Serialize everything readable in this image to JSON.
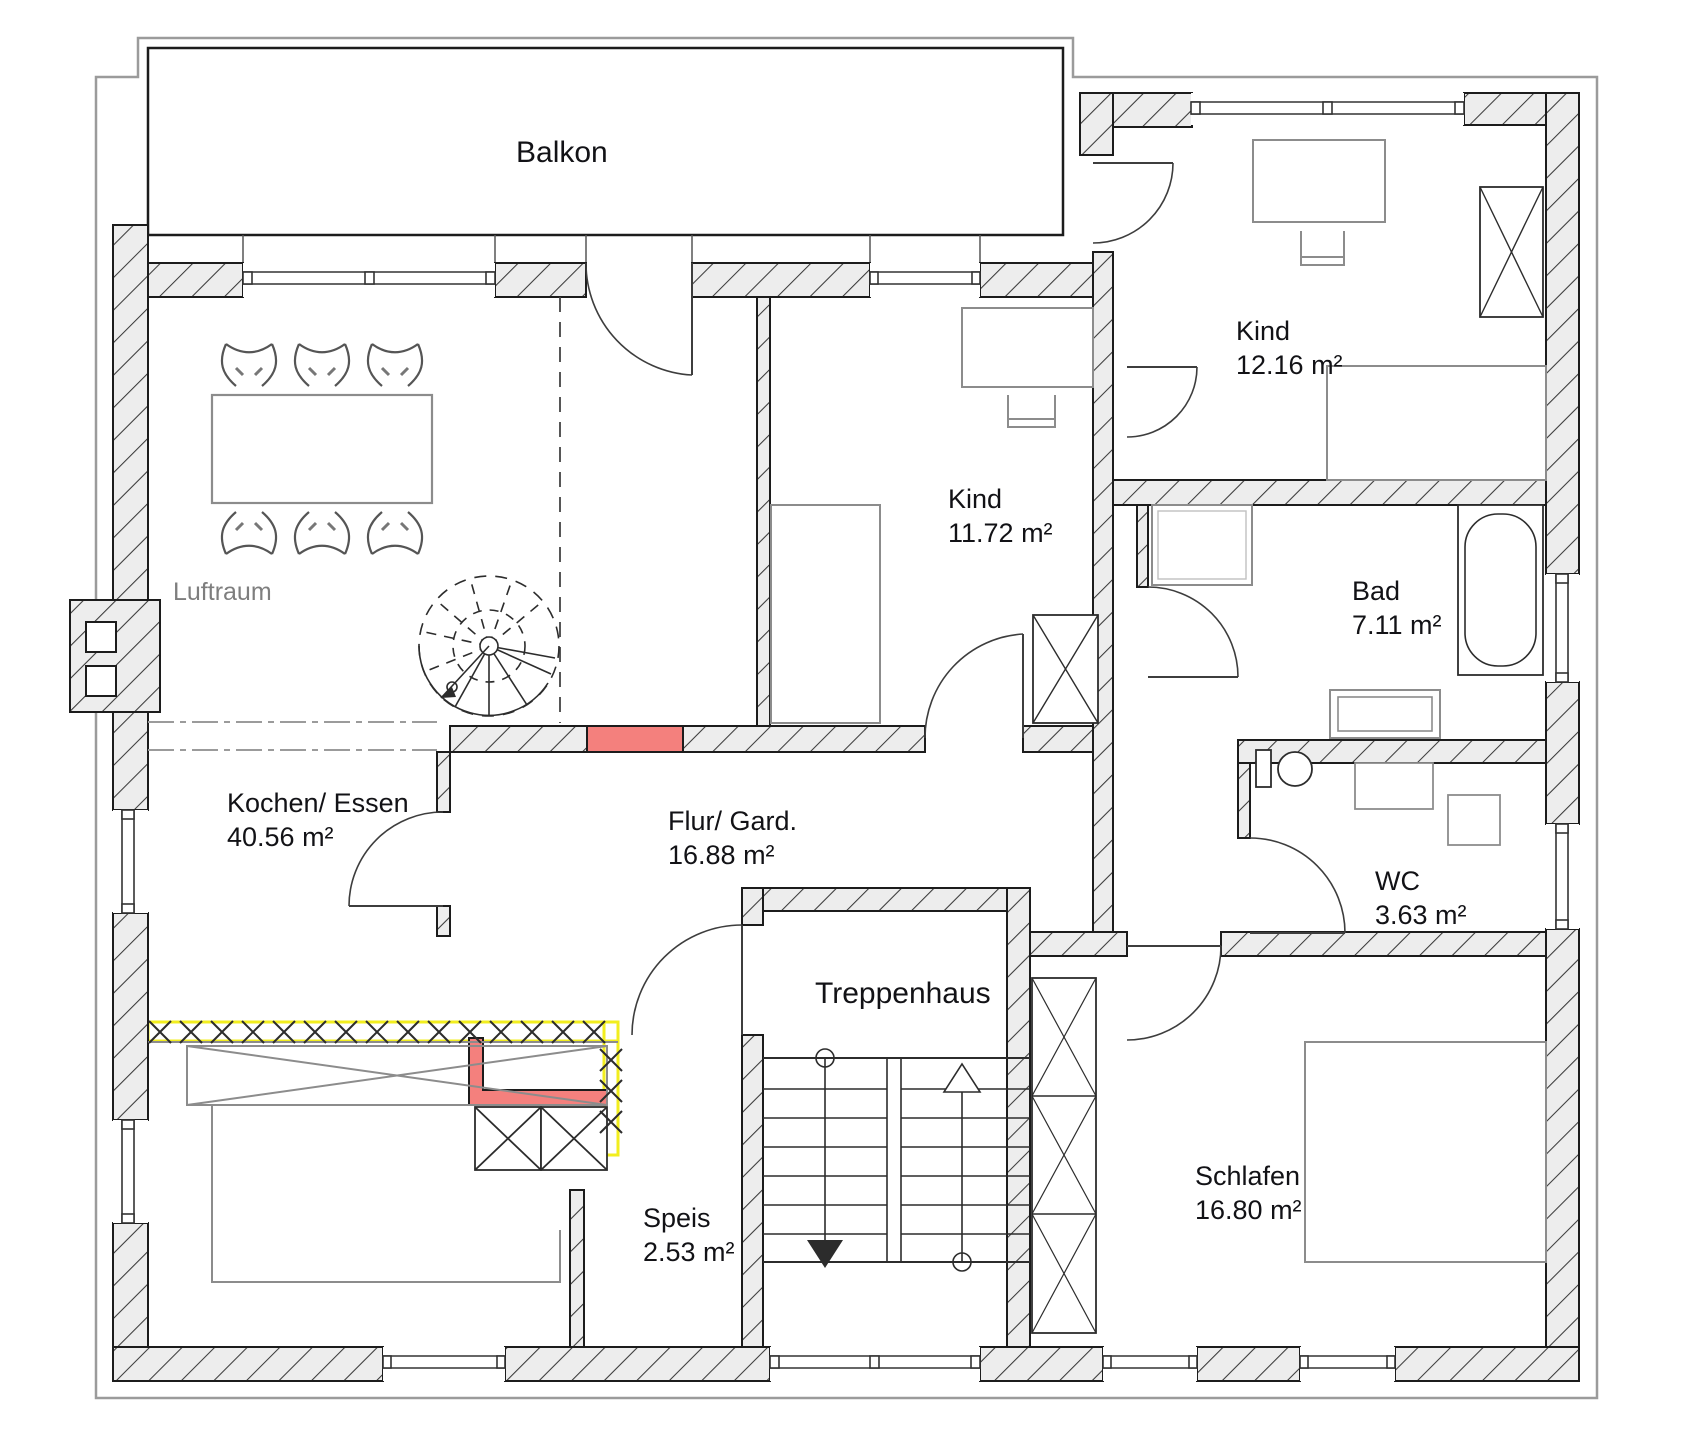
{
  "app": {
    "canvas_label": "Grundriss Obergeschoss Zeichnung"
  },
  "colors": {
    "wall_hatch_bg": "#ededed",
    "wall_line": "#1c1c1c",
    "highlight_red": "#f4807d",
    "highlight_yellow": "#f2ee1e",
    "lot_line": "#9b9b9b",
    "furniture_gray": "#8c8c8c",
    "text": "#121216",
    "muted_text": "#7e7e7e"
  },
  "rooms": {
    "balkon": {
      "name": "Balkon"
    },
    "kind1": {
      "name": "Kind",
      "area": "12.16 m²"
    },
    "kind2": {
      "name": "Kind",
      "area": "11.72 m²"
    },
    "bad": {
      "name": "Bad",
      "area": "7.11 m²"
    },
    "wc": {
      "name": "WC",
      "area": "3.63 m²"
    },
    "schlafen": {
      "name": "Schlafen",
      "area": "16.80 m²"
    },
    "treppenhaus": {
      "name": "Treppenhaus"
    },
    "speis": {
      "name": "Speis",
      "area": "2.53 m²"
    },
    "kochen": {
      "name": "Kochen/ Essen",
      "area": "40.56 m²"
    },
    "flur": {
      "name": "Flur/ Gard.",
      "area": "16.88 m²"
    },
    "luftraum": {
      "name": "Luftraum"
    }
  }
}
